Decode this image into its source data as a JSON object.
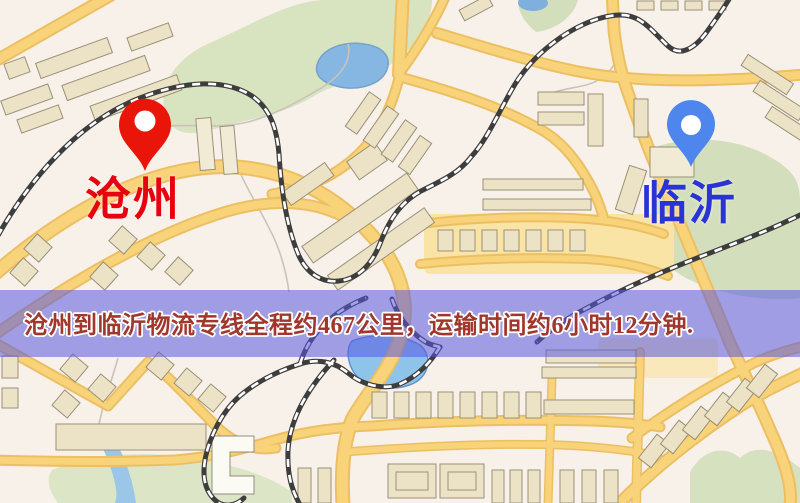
{
  "markers": {
    "origin": {
      "name": "沧州",
      "pin_color": "#e81508",
      "label_color": "#e80210"
    },
    "destination": {
      "name": "临沂",
      "pin_color": "#4e86ee",
      "label_color": "#2a33d4"
    }
  },
  "banner": {
    "text": "沧州到临沂物流专线全程约467公里，运输时间约6小时12分钟.",
    "distance_km": "467",
    "duration": "6小时12分钟",
    "background": "rgba(88,88,224,0.55)",
    "text_color": "#a1362c"
  },
  "map_colors": {
    "background": "#f8f1ea",
    "road_fill": "#f8d379",
    "road_casing": "#ecbf63",
    "park_green": "#d8e3c0",
    "water_blue": "#86b6e2",
    "building_fill": "#ece3c6",
    "railway_dark": "#3d3d3d"
  }
}
